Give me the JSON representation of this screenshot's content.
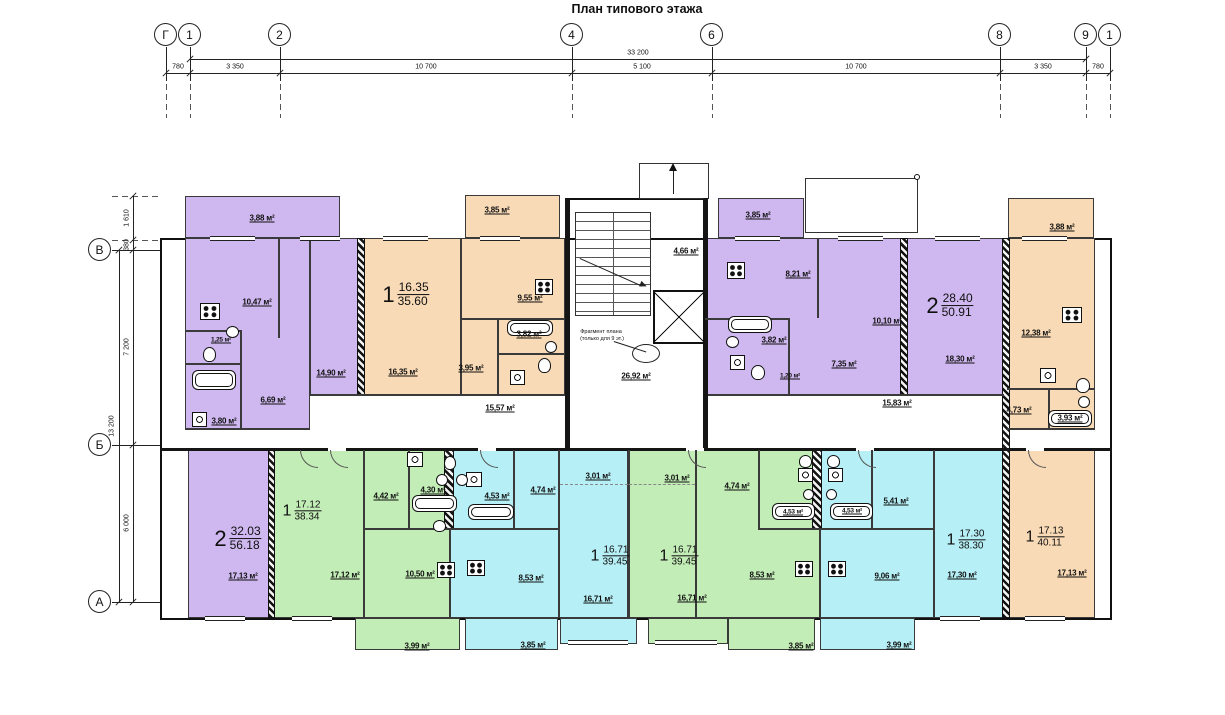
{
  "title": "План типового этажа",
  "colors": {
    "purple": "#cfb8ef",
    "orange": "#f8dab6",
    "green": "#c2edb6",
    "cyan": "#b6eff5"
  },
  "axes": {
    "top": [
      "Г",
      "1",
      "2",
      "4",
      "6",
      "8",
      "9",
      "1"
    ],
    "left": [
      "В",
      "Б",
      "А"
    ]
  },
  "dimensions": {
    "top_total": "33 200",
    "top_segments": [
      "780",
      "3 350",
      "10 700",
      "5 100",
      "10 700",
      "3 350",
      "780"
    ],
    "left_total": "13 200",
    "left_segments": [
      "1 610",
      "380",
      "7 200",
      "6 000"
    ]
  },
  "apartments": [
    {
      "rooms_count": "1",
      "living_area": "16.35",
      "total_area": "35.60"
    },
    {
      "rooms_count": "2",
      "living_area": "28.40",
      "total_area": "50.91"
    },
    {
      "rooms_count": "2",
      "living_area": "32.03",
      "total_area": "56.18"
    },
    {
      "rooms_count": "1",
      "living_area": "17.12",
      "total_area": "38.34"
    },
    {
      "rooms_count": "1",
      "living_area": "16.71",
      "total_area": "39.45"
    },
    {
      "rooms_count": "1",
      "living_area": "16.71",
      "total_area": "39.45"
    },
    {
      "rooms_count": "1",
      "living_area": "17.30",
      "total_area": "38.30"
    },
    {
      "rooms_count": "1",
      "living_area": "17.13",
      "total_area": "40.11"
    }
  ],
  "room_areas": [
    "3,88 м²",
    "3,85 м²",
    "3,85 м²",
    "3,88 м²",
    "10,47 м²",
    "14,90 м²",
    "16,35 м²",
    "6,69 м²",
    "3,80 м²",
    "1,25 м²",
    "9,55 м²",
    "3,82 м²",
    "3,95 м²",
    "15,57 м²",
    "4,66 м²",
    "26,92 м²",
    "8,21 м²",
    "10,10 м²",
    "18,30 м²",
    "7,35 м²",
    "3,82 м²",
    "1,20 м²",
    "15,83 м²",
    "12,38 м²",
    "4,73 м²",
    "3,93 м²",
    "17,13 м²",
    "17,12 м²",
    "4,42 м²",
    "4,30 м²",
    "10,50 м²",
    "4,53 м²",
    "4,74 м²",
    "3,01 м²",
    "3,01 м²",
    "4,74 м²",
    "4,53 м²",
    "4,53 м²",
    "5,41 м²",
    "8,53 м²",
    "8,53 м²",
    "16,71 м²",
    "16,71 м²",
    "9,06 м²",
    "17,30 м²",
    "17,13 м²",
    "3,99 м²",
    "3,85 м²",
    "3,85 м²",
    "3,99 м²"
  ],
  "annotations": {
    "fragment_note_line1": "Фрагмент плана",
    "fragment_note_line2": "(только для 9 эт.)"
  }
}
